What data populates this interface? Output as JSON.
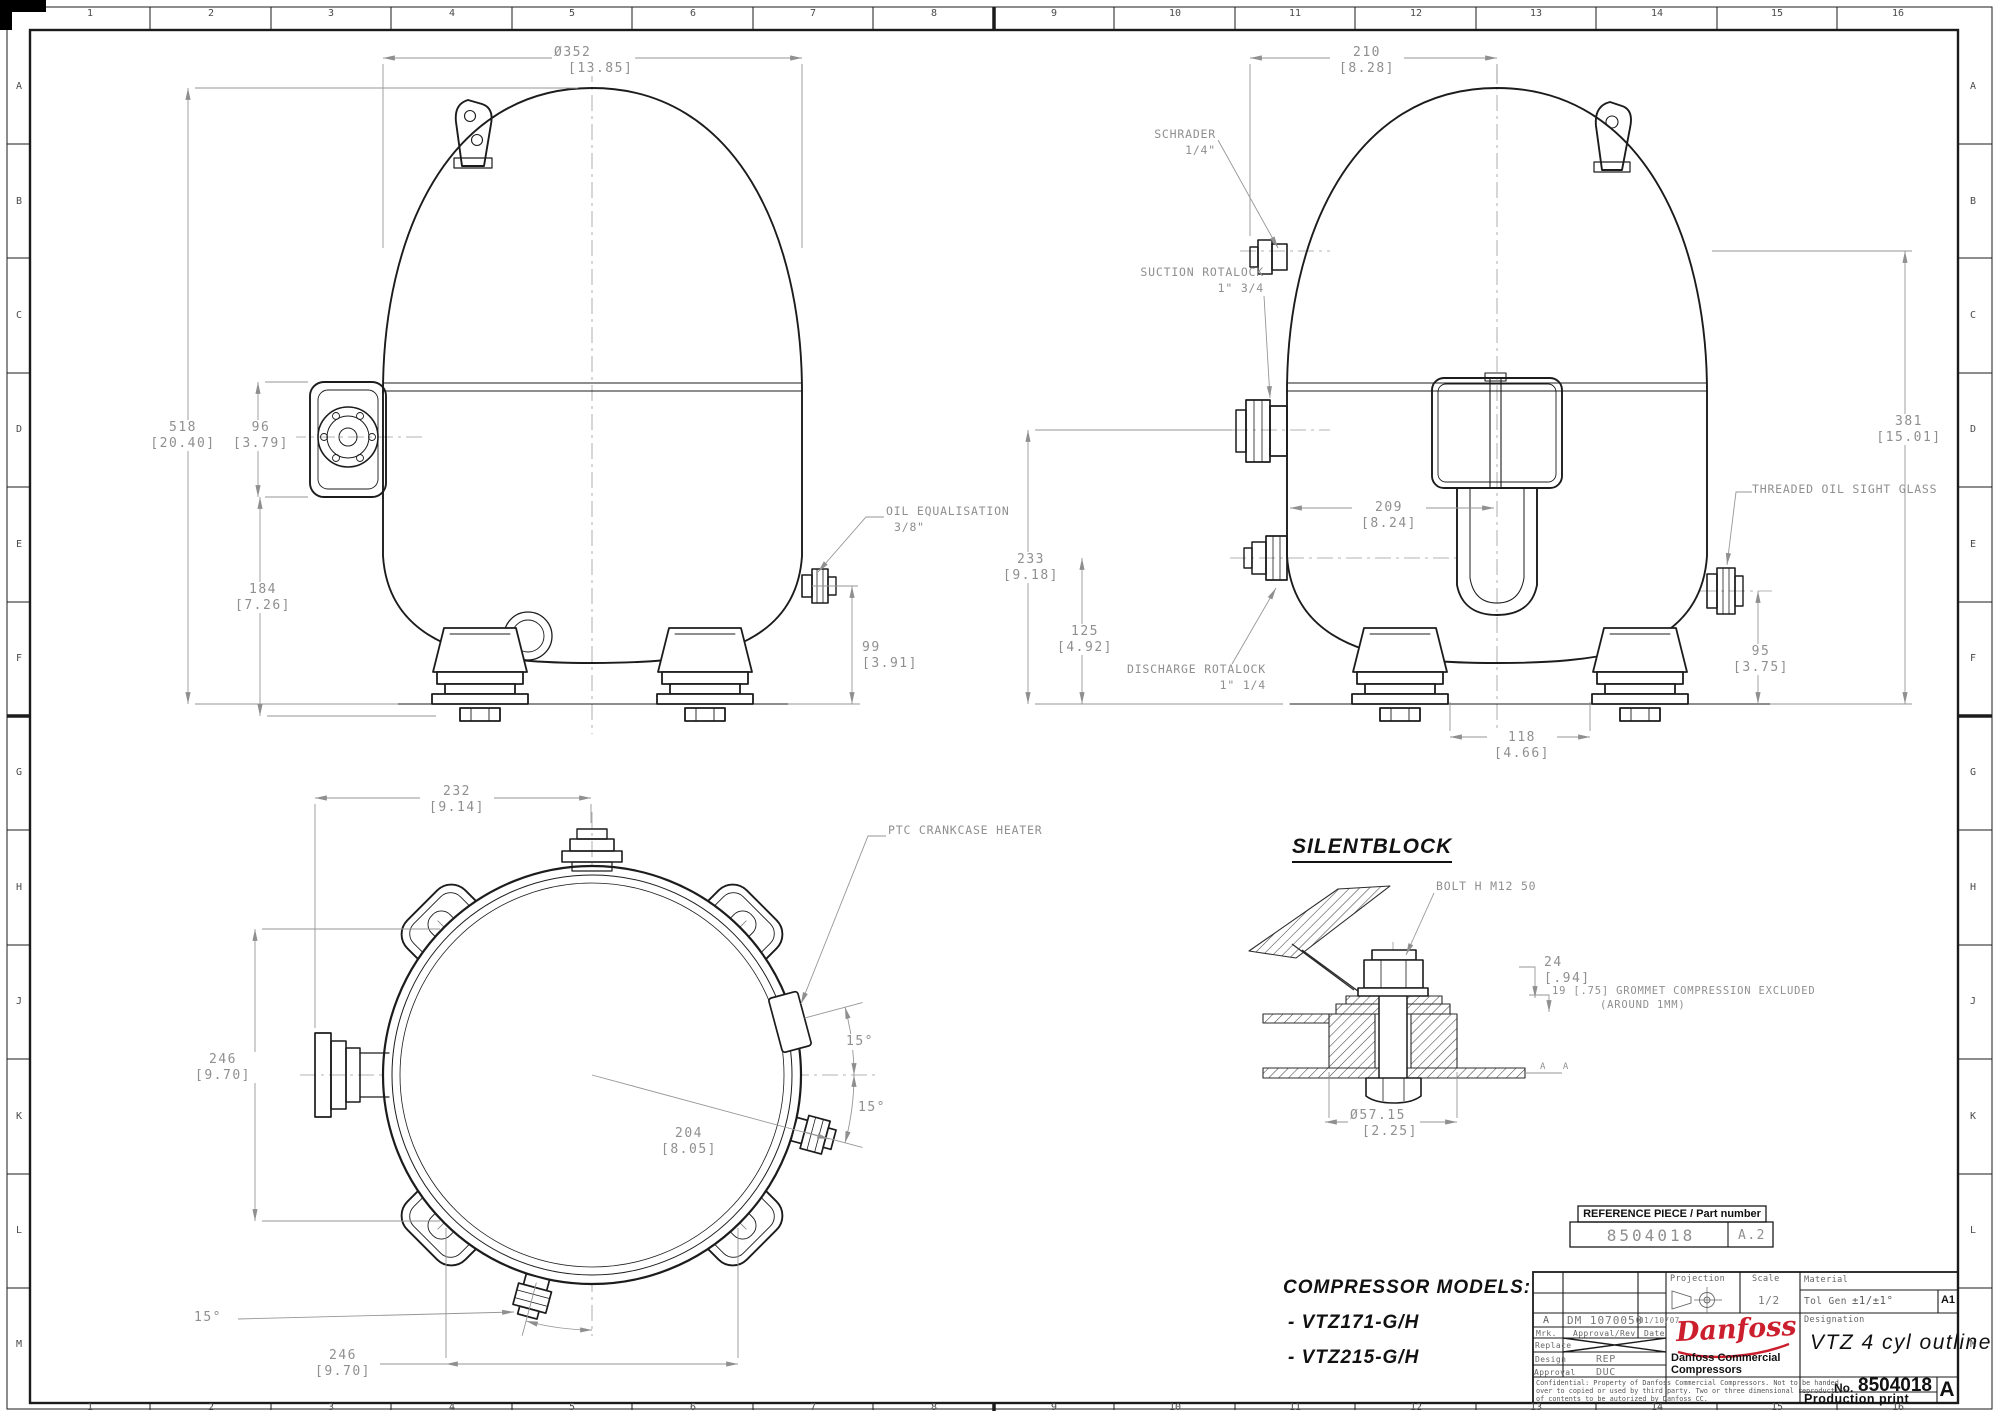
{
  "frame": {
    "cols": [
      "1",
      "2",
      "3",
      "4",
      "5",
      "6",
      "7",
      "8",
      "9",
      "10",
      "11",
      "12",
      "13",
      "14",
      "15",
      "16"
    ],
    "rows": [
      "A",
      "B",
      "C",
      "D",
      "E",
      "F",
      "G",
      "H",
      "J",
      "K",
      "L",
      "M"
    ]
  },
  "front_view": {
    "dia": {
      "mm": "Ø352",
      "in": "[13.85]"
    },
    "h518": {
      "mm": "518",
      "in": "[20.40]"
    },
    "h96": {
      "mm": "96",
      "in": "[3.79]"
    },
    "h184": {
      "mm": "184",
      "in": "[7.26]"
    },
    "h99": {
      "mm": "99",
      "in": "[3.91]"
    },
    "oil": {
      "line1": "OIL EQUALISATION",
      "line2": "3/8\""
    }
  },
  "side_view": {
    "w210": {
      "mm": "210",
      "in": "[8.28]"
    },
    "schrader": {
      "line1": "SCHRADER",
      "line2": "1/4\""
    },
    "suction": {
      "line1": "SUCTION ROTALOCK",
      "line2": "1\" 3/4"
    },
    "h381": {
      "mm": "381",
      "in": "[15.01]"
    },
    "sight_glass": "THREADED OIL SIGHT GLASS",
    "d209": {
      "mm": "209",
      "in": "[8.24]"
    },
    "h233": {
      "mm": "233",
      "in": "[9.18]"
    },
    "h125": {
      "mm": "125",
      "in": "[4.92]"
    },
    "discharge": {
      "line1": "DISCHARGE ROTALOCK",
      "line2": "1\" 1/4"
    },
    "w118": {
      "mm": "118",
      "in": "[4.66]"
    },
    "h95": {
      "mm": "95",
      "in": "[3.75]"
    }
  },
  "top_view": {
    "w232": {
      "mm": "232",
      "in": "[9.14]"
    },
    "ptc": "PTC CRANKCASE HEATER",
    "h246": {
      "mm": "246",
      "in": "[9.70]"
    },
    "d204": {
      "mm": "204",
      "in": "[8.05]"
    },
    "w246": {
      "mm": "246",
      "in": "[9.70]"
    },
    "angle1": "15°",
    "angle2": "15°",
    "angle3": "15°"
  },
  "silentblock": {
    "title": "SILENTBLOCK",
    "bolt": "BOLT H M12 50",
    "d24": {
      "mm": "24",
      "in": "[.94]"
    },
    "grommet": {
      "line1": "19 [.75] GROMMET COMPRESSION EXCLUDED",
      "line2": "(AROUND 1MM)"
    },
    "dia": {
      "mm": "Ø57.15",
      "in": "[2.25]"
    },
    "section": "A A"
  },
  "models": {
    "heading": "COMPRESSOR MODELS:",
    "item1": "- VTZ171-G/H",
    "item2": "- VTZ215-G/H"
  },
  "reference": {
    "header": "REFERENCE PIECE / Part number",
    "part": "8504018",
    "rev": "A.2"
  },
  "title_block": {
    "projection_label": "Projection",
    "scale_label": "Scale",
    "scale_value": "1/2",
    "material_label": "Material",
    "tol_label": "Tol Gen",
    "tol_value": "±1/±1°",
    "size": "A1",
    "designation_label": "Designation",
    "designation_value": "VTZ 4 cyl outline",
    "logo_text": "Danfoss",
    "company_line1": "Danfoss Commercial",
    "company_line2": "Compressors",
    "no_label": "No.",
    "no_value": "8504018",
    "print_label": "Production print",
    "sheet_rev": "A",
    "rev_row": {
      "mark": "A",
      "doc": "DM 1070050",
      "date": "01/10/07"
    },
    "header_row": {
      "mark": "Mrk.",
      "approval": "Approval/Rev",
      "date": "Date"
    },
    "replace_label": "Replace",
    "design_label": "Design",
    "design_value": "REP",
    "approval_label": "Approval",
    "approval_value": "DUC",
    "confidential": {
      "line1": "Confidential: Property of Danfoss Commercial Compressors. Not to be handed",
      "line2": "over to copied or used by third party. Two or three dimensional reproduction",
      "line3": "of contents to be autorized by Danfoss CC."
    }
  },
  "colors": {
    "line": "#1c1c1c",
    "dim_text": "#8f8f8f",
    "logo_red": "#cc1f2e",
    "accent_black": "#111111"
  }
}
